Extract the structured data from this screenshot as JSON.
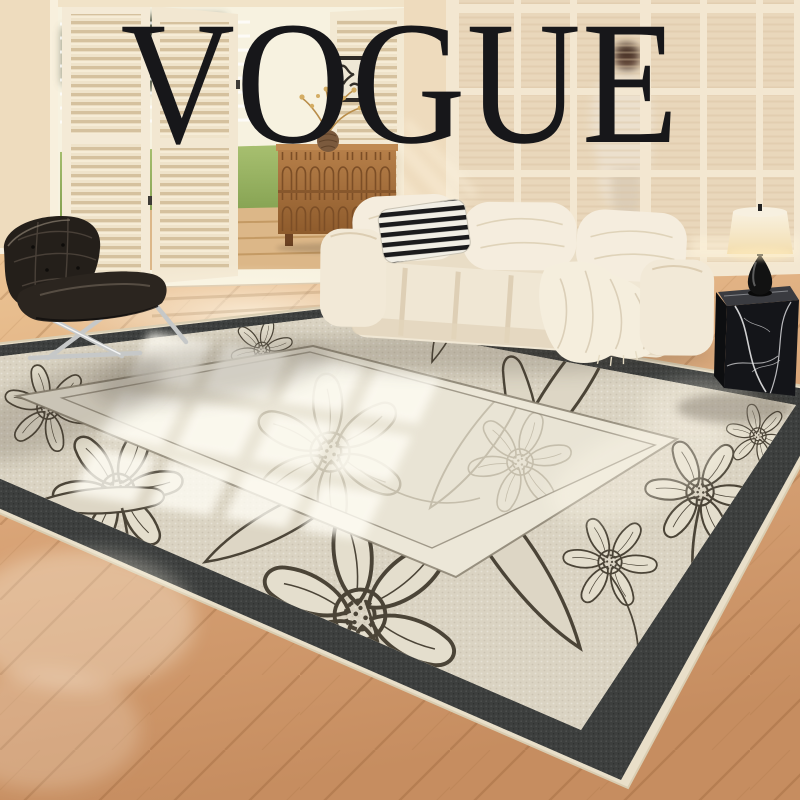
{
  "overlay": {
    "brand": "VOGUE",
    "color": "#17171a"
  },
  "scene": {
    "description": "Sunlit living room staged to showcase a floral ivory area rug with charcoal border",
    "objects": [
      "open-shutter-doors",
      "garden-view",
      "framed-artwork",
      "wood-credenza",
      "vase-with-dried-branches",
      "glass-partition",
      "walking-person",
      "cream-modular-sofa",
      "striped-pillow",
      "throw-blanket",
      "black-leather-lounge-chair",
      "chrome-chair-legs",
      "black-marble-cube-table",
      "table-lamp",
      "floral-area-rug",
      "window-light-reflection",
      "chevron-wood-floor"
    ],
    "colors": {
      "wall": "#f0e0c6",
      "floor_wood": "#d5a374",
      "rug_field": "#dad3c2",
      "rug_inner_field": "#e9e4d5",
      "rug_border": "#3d3f3e",
      "rug_line_art": "#4b4437",
      "sofa": "#f0e7d4",
      "chair_leather": "#241f1a",
      "chrome": "#c6c8c8",
      "lamp_shade": "#f6eed8",
      "marble_table": "#141519",
      "credenza_wood": "#a9713f",
      "garden_green": "#8fae5d"
    }
  }
}
